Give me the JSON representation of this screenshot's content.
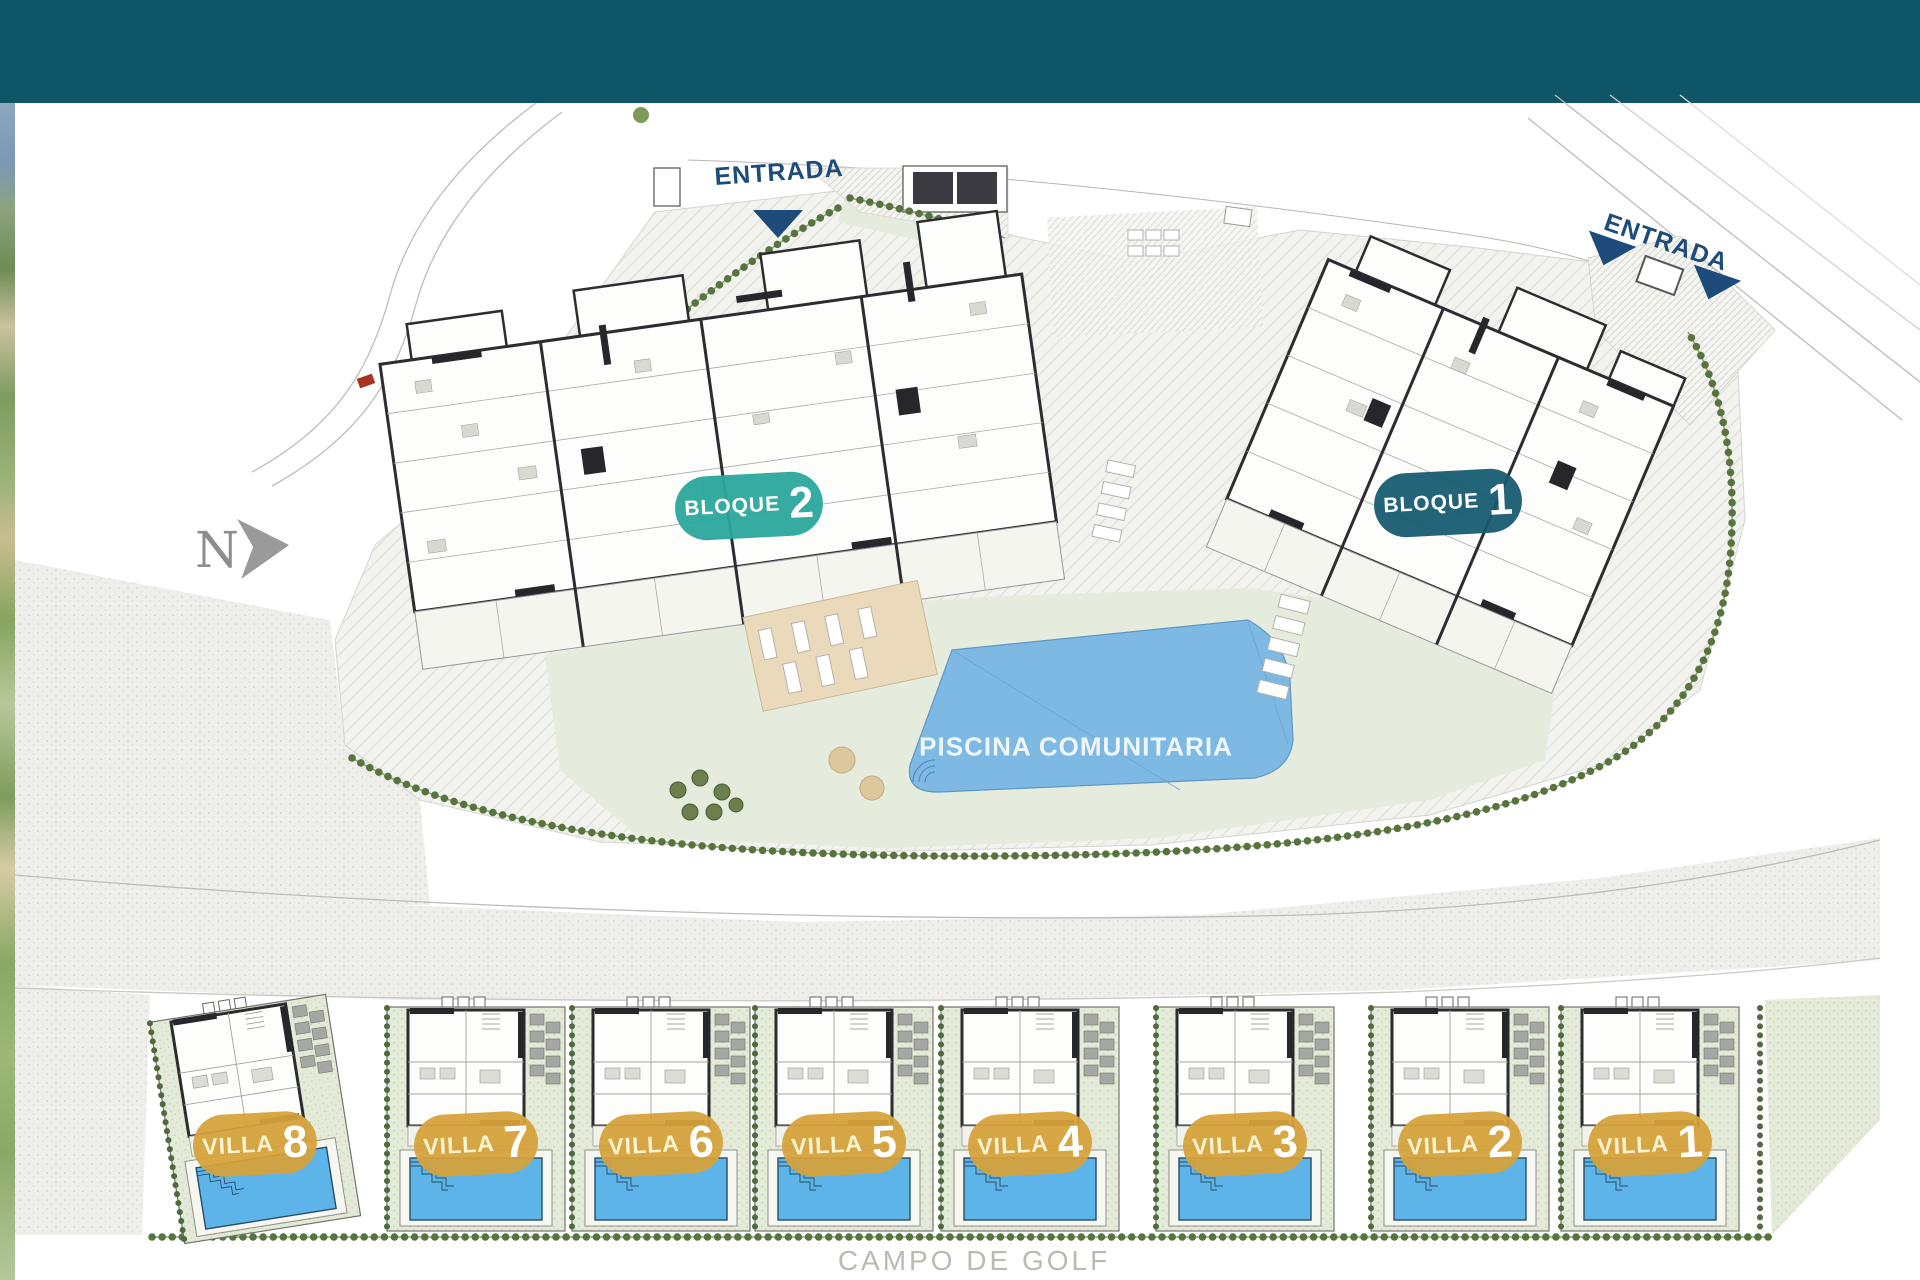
{
  "colors": {
    "header_bar": "#0f5568",
    "block2_badge": "#2aa69d",
    "block1_badge": "#165a70",
    "villa_badge": "#d8a23b",
    "communal_pool": "#7db9e2",
    "villa_pool": "#5cb4e8",
    "entrance_text": "#1d4b7a",
    "golf_text": "#b6bdae",
    "north_indicator": "#8d8d8d"
  },
  "plan": {
    "north": {
      "label": "N"
    },
    "entrances": [
      {
        "label": "ENTRADA"
      },
      {
        "label": "ENTRADA"
      }
    ],
    "blocks": [
      {
        "label": "BLOQUE",
        "number": "2"
      },
      {
        "label": "BLOQUE",
        "number": "1"
      }
    ],
    "pool": {
      "label": "PISCINA COMUNITARIA"
    },
    "villas": [
      {
        "label": "VILLA",
        "number": "8"
      },
      {
        "label": "VILLA",
        "number": "7"
      },
      {
        "label": "VILLA",
        "number": "6"
      },
      {
        "label": "VILLA",
        "number": "5"
      },
      {
        "label": "VILLA",
        "number": "4"
      },
      {
        "label": "VILLA",
        "number": "3"
      },
      {
        "label": "VILLA",
        "number": "2"
      },
      {
        "label": "VILLA",
        "number": "1"
      }
    ],
    "golf": {
      "label": "CAMPO DE GOLF"
    }
  }
}
